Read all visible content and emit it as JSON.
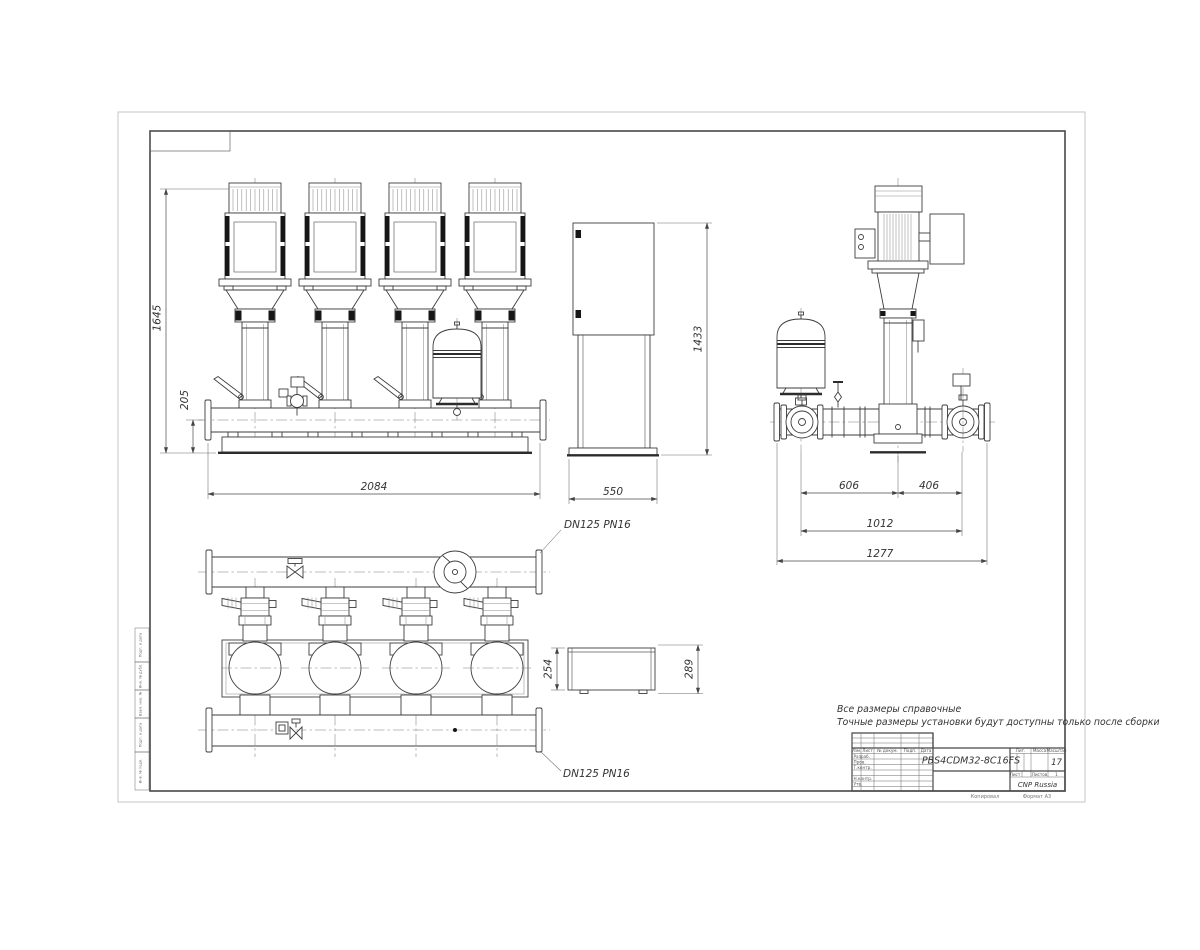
{
  "dimensions": {
    "front_height": "1645",
    "manifold_height": "205",
    "front_width": "2084",
    "cabinet_height": "1433",
    "cabinet_width": "550",
    "side_left_span": "606",
    "side_right_span": "406",
    "side_valve_span": "1012",
    "side_total_span": "1277",
    "cabinet_top_depth": "254",
    "cabinet_top_width": "289"
  },
  "labels": {
    "dn_top": "DN125 PN16",
    "dn_bottom": "DN125 PN16"
  },
  "notes": {
    "line1": "Все размеры справочные",
    "line2": "Точные размеры установки будут доступны только после сборки"
  },
  "title_block": {
    "designation": "PBS4CDM32-8C16FS",
    "scale_value": "17",
    "company": "CNP Russia",
    "headers": {
      "lit": "Лит.",
      "mass": "Масса",
      "scale": "Масштаб",
      "sheet": "Лист",
      "sheets": "Листов",
      "sheets_value": "1"
    },
    "cols": {
      "izm": "Изм.",
      "list": "Лист",
      "doc": "№ докум.",
      "sign": "Подп.",
      "date": "Дата"
    },
    "rows": {
      "developed": "Разраб.",
      "checked": "Пров.",
      "tcontrol": "Т.контр.",
      "ncontrol": "Н.контр.",
      "approved": "Утв."
    },
    "footer": {
      "copied": "Копировал",
      "format": "Формат А3"
    }
  },
  "side_stamps": [
    "Подп. и дата",
    "Инв. № дубл.",
    "Взам. инв. №",
    "Подп. и дата",
    "Инв. № подл."
  ]
}
